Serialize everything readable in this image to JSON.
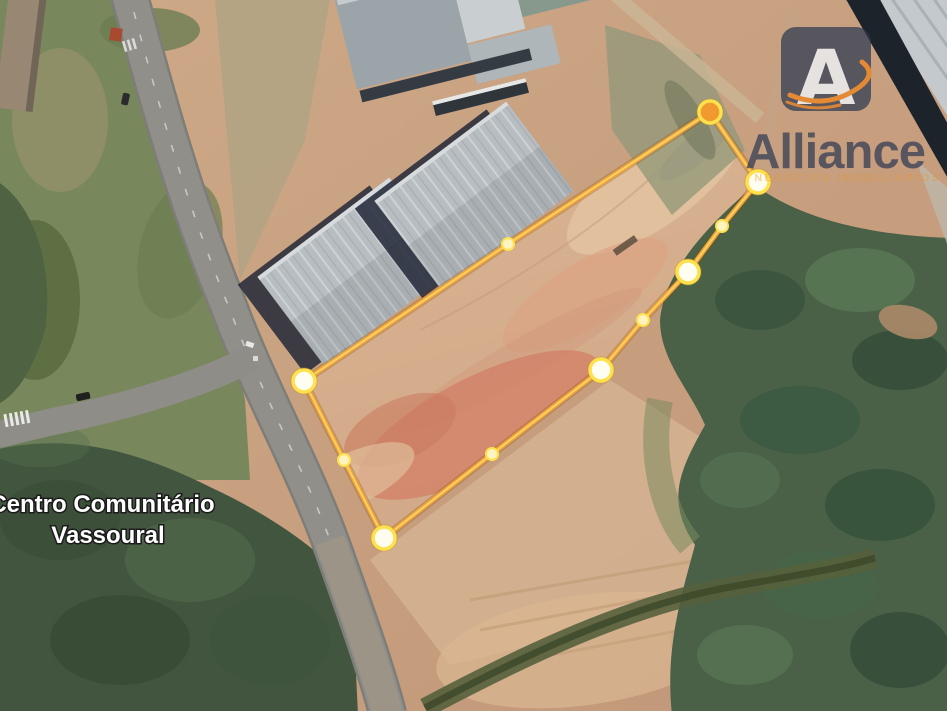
{
  "map": {
    "type": "satellite-imagery",
    "place_label": {
      "line1": "Centro Comunitário",
      "line2": "Vassoural"
    }
  },
  "watermark": {
    "brand": "Alliance",
    "brand_initial": "A",
    "tagline": "NEGÓCIOS IMOBILIÁRIOS",
    "badge_color": "#2c3850",
    "initial_color": "#f3f4f6",
    "text_color": "#2c3852",
    "swoosh_color": "#e8872b",
    "tagline_color": "#e8962e"
  },
  "parcel": {
    "description": "land-parcel-boundary",
    "stroke_color": "#f0a33a",
    "highlight_color": "#ffd96a",
    "shadow_color": "rgba(130,75,5,0.28)",
    "vertex_ring_color": "#ffe14d",
    "vertex_outer_rim": "#c8921e",
    "vertex_fill_light": "#fffdf0",
    "vertex_fill_small": "#fff3c2",
    "vertex_fill_orange": "#f0992e",
    "vertices": [
      {
        "x": 710,
        "y": 112,
        "size": "large",
        "fill": "orange"
      },
      {
        "x": 758,
        "y": 182,
        "size": "large",
        "fill": "light"
      },
      {
        "x": 722,
        "y": 226,
        "size": "small",
        "fill": "light"
      },
      {
        "x": 688,
        "y": 272,
        "size": "large",
        "fill": "light"
      },
      {
        "x": 643,
        "y": 320,
        "size": "small",
        "fill": "light"
      },
      {
        "x": 601,
        "y": 370,
        "size": "large",
        "fill": "light"
      },
      {
        "x": 492,
        "y": 454,
        "size": "small",
        "fill": "light"
      },
      {
        "x": 384,
        "y": 538,
        "size": "large",
        "fill": "light"
      },
      {
        "x": 344,
        "y": 460,
        "size": "small",
        "fill": "light"
      },
      {
        "x": 304,
        "y": 381,
        "size": "large",
        "fill": "light"
      },
      {
        "x": 508,
        "y": 244,
        "size": "small",
        "fill": "light"
      }
    ]
  }
}
